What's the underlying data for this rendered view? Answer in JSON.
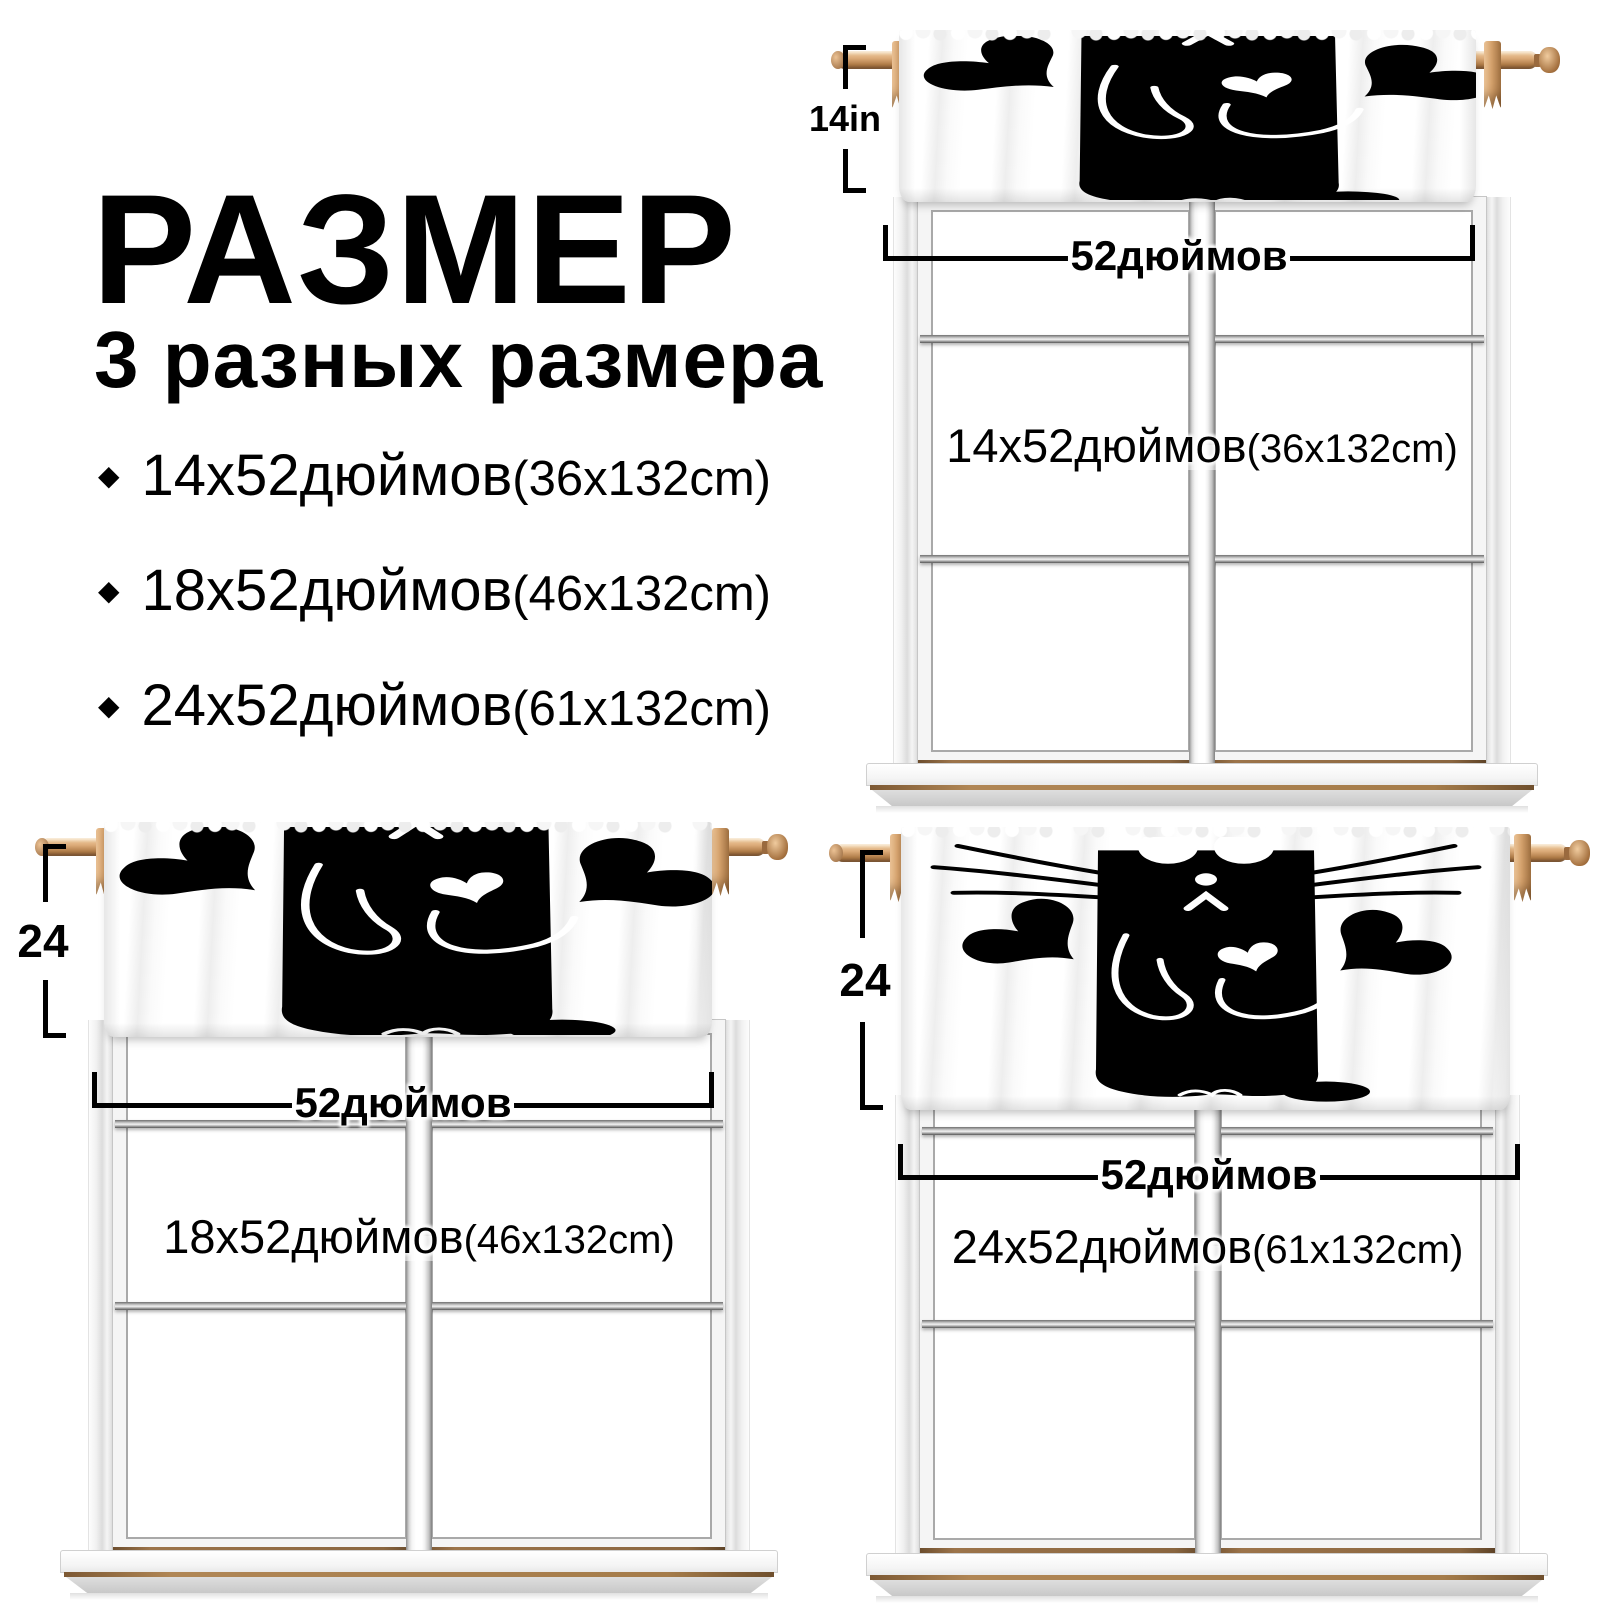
{
  "title": {
    "text": "РАЗМЕР",
    "subtitle": "3 разных размера"
  },
  "size_list": [
    {
      "bullet": "◆",
      "main": "14х52дюймов",
      "metric": "(36x132cm)"
    },
    {
      "bullet": "◆",
      "main": "18х52дюймов",
      "metric": "(46x132cm)"
    },
    {
      "bullet": "◆",
      "main": "24х52дюймов",
      "metric": "(61x132cm)"
    }
  ],
  "windows": [
    {
      "position": "top-right",
      "height_label": "14in",
      "width_label": "52дюймов",
      "size_main": "14х52дюймов",
      "size_metric": "(36x132cm)"
    },
    {
      "position": "bottom-left",
      "height_label": "24",
      "width_label": "52дюймов",
      "size_main": "18х52дюймов",
      "size_metric": "(46x132cm)"
    },
    {
      "position": "bottom-right",
      "height_label": "24",
      "width_label": "52дюймов",
      "size_main": "24х52дюймов",
      "size_metric": "(61x132cm)"
    }
  ],
  "icons": {
    "bullet": "diamond-bullet",
    "valance_art": "black-cat-holding-heart"
  },
  "colors": {
    "text": "#000000",
    "valance_black": "#000000",
    "rod_wood": "#d9a97c",
    "rod_wood_dark": "#8f6036",
    "metal_bar": "#8a8a8a",
    "sill_wood_line": "#a57c4a"
  }
}
